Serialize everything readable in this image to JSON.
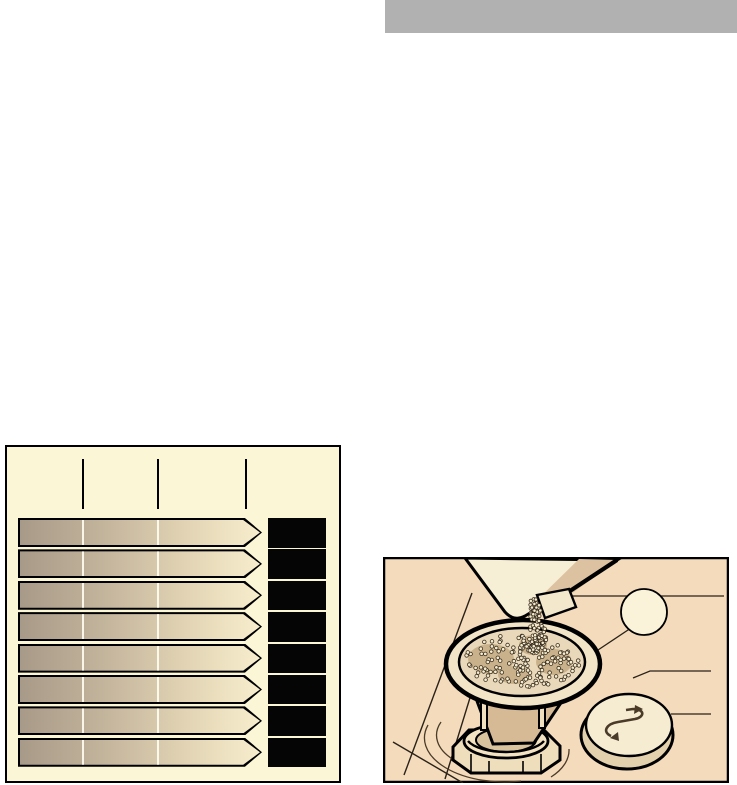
{
  "page": {
    "width": 737,
    "height": 785,
    "background": "#ffffff"
  },
  "top_bar": {
    "color": "#b1b1b1"
  },
  "hardness_table": {
    "background": "#fbf7d6",
    "border_color": "#000000",
    "tick_color": "#000000",
    "tick_count": 3,
    "row_count": 8,
    "bar": {
      "gradient_start": "#a89a88",
      "gradient_end": "#f7eecd",
      "outline": "#000000",
      "divider_color": "#fffef2"
    },
    "value_box_color": "#050505",
    "rows": [
      {
        "label": "",
        "value": ""
      },
      {
        "label": "",
        "value": ""
      },
      {
        "label": "",
        "value": ""
      },
      {
        "label": "",
        "value": ""
      },
      {
        "label": "",
        "value": ""
      },
      {
        "label": "",
        "value": ""
      },
      {
        "label": "",
        "value": ""
      },
      {
        "label": "",
        "value": ""
      }
    ]
  },
  "illustration": {
    "background": "#f3dbbc",
    "border_color": "#000000",
    "line_color": "#2a2118",
    "callout": {
      "label": "",
      "fill": "#faf3da"
    },
    "cap_symbol": "screw-direction-arrows",
    "granules": {
      "stream_count": 75,
      "bowl_count": 175,
      "pile_count": 35,
      "dot_fill": "#f5ebcd",
      "dot_stroke": "#3a2e20"
    }
  }
}
